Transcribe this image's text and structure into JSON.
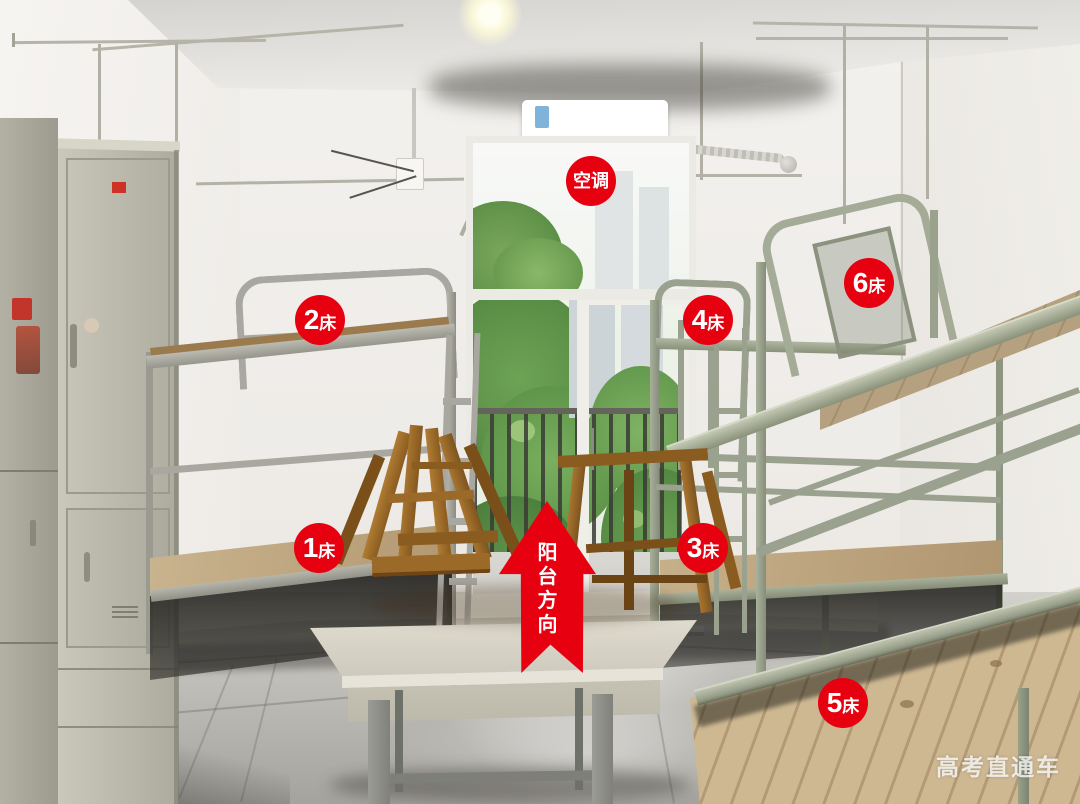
{
  "scene": {
    "description": "Dormitory room photo: six metal bunk beds, lockers, balcony door with greenery, table with stacked wooden stools, red annotation overlays",
    "accent_color": "#e7000f",
    "label_text_color": "#ffffff"
  },
  "annotations": {
    "ac_label": {
      "text": "空调"
    },
    "bed_markers": [
      {
        "num": "1",
        "suffix": "床"
      },
      {
        "num": "2",
        "suffix": "床"
      },
      {
        "num": "3",
        "suffix": "床"
      },
      {
        "num": "4",
        "suffix": "床"
      },
      {
        "num": "5",
        "suffix": "床"
      },
      {
        "num": "6",
        "suffix": "床"
      }
    ],
    "direction_arrow": {
      "text": "阳台方向",
      "chars": [
        "阳",
        "台",
        "方",
        "向"
      ]
    },
    "watermark": {
      "text": "高考直通车"
    }
  }
}
